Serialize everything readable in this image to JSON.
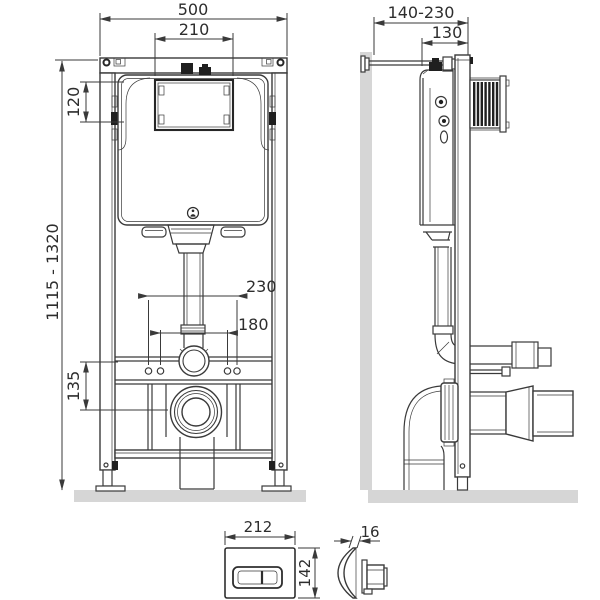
{
  "front_view": {
    "width_top": "500",
    "window_width": "210",
    "window_height": "120",
    "install_height": "1115 - 1320",
    "drain_height": "135",
    "fixing_wide": "230",
    "fixing_narrow": "180"
  },
  "side_view": {
    "depth_adjust": "140-230",
    "depth": "130"
  },
  "flush_plate": {
    "width": "212",
    "height": "142",
    "thickness": "16"
  },
  "colors": {
    "line": "#3a3a3a",
    "surface_gray": "#d6d6d6",
    "accent_dark": "#1f1f1f",
    "background": "#ffffff"
  }
}
